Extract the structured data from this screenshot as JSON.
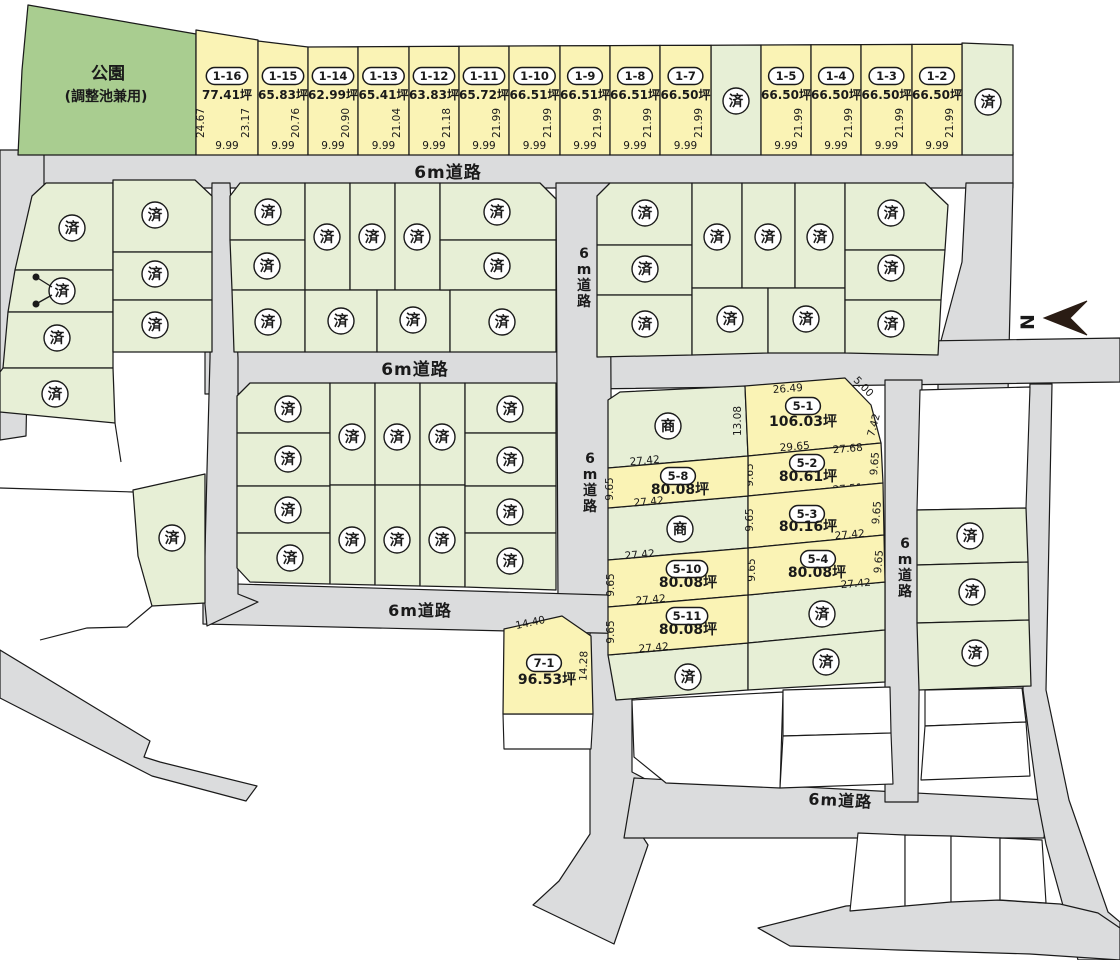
{
  "park": {
    "line1": "公園",
    "line2": "(調整池兼用)"
  },
  "road_label": "6m道路",
  "sold_label": "済",
  "commercial_label": "商",
  "north_label": "N",
  "banners": [
    {
      "label": "坪数増減可!"
    },
    {
      "label": "建築条件なし"
    }
  ],
  "colors": {
    "for_sale_fill": "#FAF3B5",
    "sold_fill": "#E7EFD6",
    "park_fill": "#A9CD90",
    "road_fill": "#DBDCDD",
    "accent_orange": "#EF8636",
    "outline": "#1A1A1A",
    "north_arrow": "#2A1C14"
  },
  "top_row": [
    {
      "id": "1-16",
      "area": "77.41坪",
      "left_len": "24.67",
      "right_len": "23.17",
      "bottom_len": "9.99"
    },
    {
      "id": "1-15",
      "area": "65.83坪",
      "right_len": "20.76",
      "bottom_len": "9.99"
    },
    {
      "id": "1-14",
      "area": "62.99坪",
      "right_len": "20.90",
      "bottom_len": "9.99"
    },
    {
      "id": "1-13",
      "area": "65.41坪",
      "right_len": "21.04",
      "bottom_len": "9.99"
    },
    {
      "id": "1-12",
      "area": "63.83坪",
      "right_len": "21.18",
      "bottom_len": "9.99"
    },
    {
      "id": "1-11",
      "area": "65.72坪",
      "right_len": "21.99",
      "bottom_len": "9.99"
    },
    {
      "id": "1-10",
      "area": "66.51坪",
      "right_len": "21.99",
      "bottom_len": "9.99"
    },
    {
      "id": "1-9",
      "area": "66.51坪",
      "right_len": "21.99",
      "bottom_len": "9.99"
    },
    {
      "id": "1-8",
      "area": "66.51坪",
      "right_len": "21.99",
      "bottom_len": "9.99"
    },
    {
      "id": "1-7",
      "area": "66.50坪",
      "right_len": "21.99",
      "bottom_len": "9.99"
    },
    {
      "sold": true
    },
    {
      "id": "1-5",
      "area": "66.50坪",
      "right_len": "21.99",
      "bottom_len": "9.99"
    },
    {
      "id": "1-4",
      "area": "66.50坪",
      "right_len": "21.99",
      "bottom_len": "9.99"
    },
    {
      "id": "1-3",
      "area": "66.50坪",
      "right_len": "21.99",
      "bottom_len": "9.99"
    },
    {
      "id": "1-2",
      "area": "66.50坪",
      "right_len": "21.99",
      "bottom_len": "9.99"
    },
    {
      "sold": true
    }
  ],
  "block5": {
    "5-1": {
      "id": "5-1",
      "area": "106.03坪",
      "m_top": "26.49",
      "m_corner": "5.00",
      "m_left": "13.08",
      "m_right": "7.42",
      "m_bottom": "29.65"
    },
    "5-2": {
      "id": "5-2",
      "area": "80.61坪",
      "m_top": "27.68",
      "m_left": "9.65",
      "m_right": "9.65",
      "m_bottom": "27.51"
    },
    "5-3": {
      "id": "5-3",
      "area": "80.16坪",
      "m_left": "9.65",
      "m_right": "9.65",
      "m_bottom": "27.42"
    },
    "5-4": {
      "id": "5-4",
      "area": "80.08坪",
      "m_left": "9.65",
      "m_right": "9.65",
      "m_bottom": "27.42"
    },
    "5-8": {
      "id": "5-8",
      "area": "80.08坪",
      "m_top": "27.42",
      "m_left": "9.65",
      "m_bottom": "27.42"
    },
    "5-10": {
      "id": "5-10",
      "area": "80.08坪",
      "m_top": "27.42",
      "m_left": "9.65",
      "m_bottom": "27.42"
    },
    "5-11": {
      "id": "5-11",
      "area": "80.08坪",
      "m_left": "9.65",
      "m_bottom": "27.42"
    }
  },
  "plot71": {
    "id": "7-1",
    "area": "96.53坪",
    "m_top": "14.40",
    "m_right": "14.28"
  }
}
